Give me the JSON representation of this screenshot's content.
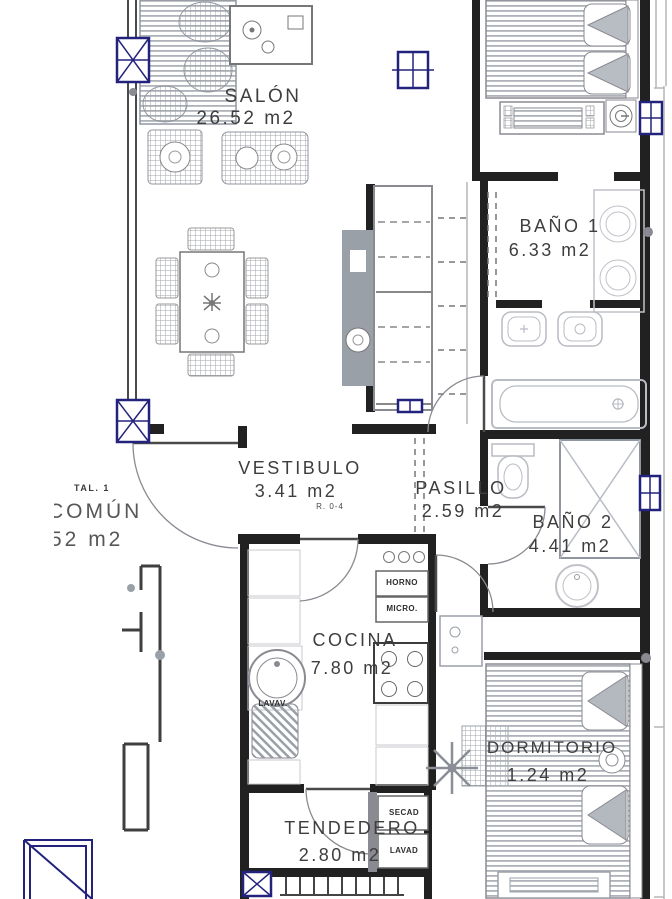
{
  "rooms": {
    "salon": {
      "name": "SALÓN",
      "area": "26.52 m2"
    },
    "bano1": {
      "name": "BAÑO 1",
      "area": "6.33 m2"
    },
    "vestibulo": {
      "name": "VESTIBULO",
      "area": "3.41 m2",
      "note": "R. 0-4"
    },
    "pasillo": {
      "name": "PASILLO",
      "area": "2.59 m2"
    },
    "bano2": {
      "name": "BAÑO 2",
      "area": "4.41 m2"
    },
    "cocina": {
      "name": "COCINA",
      "area": "7.80 m2"
    },
    "tendedero": {
      "name": "TENDEDERO",
      "area": "2.80 m2"
    },
    "dormitorio": {
      "name": "DORMITORIO",
      "area": "1.24 m2"
    },
    "zona_comun": {
      "line1": "TAL. 1",
      "line2": "COMÚN",
      "line3": "52 m2"
    }
  },
  "appliances": {
    "horno": "HORNO",
    "micro": "MICRO.",
    "lavav": "LAVAV.",
    "secad": "SECAD",
    "lavad": "LAVAD"
  },
  "colors": {
    "wall": "#212121",
    "furniture_gray": "#9aa0a8",
    "fixture_light": "#b8bcc3",
    "window_blue": "#23237d",
    "label_text": "#3e3e3e"
  }
}
